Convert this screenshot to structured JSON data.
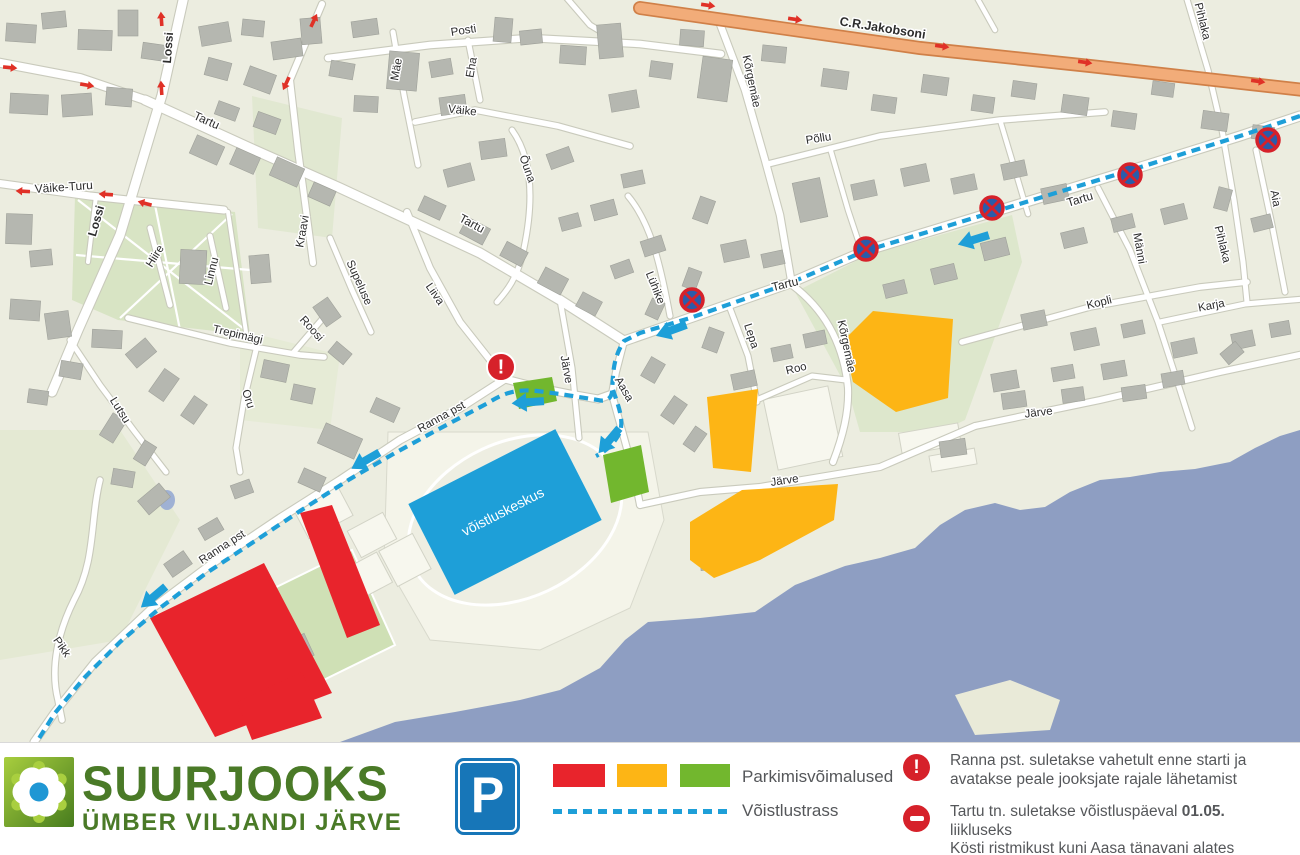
{
  "colors": {
    "land": "#ECEDE0",
    "water": "#8E9EC2",
    "park": "#D8E4C4",
    "field": "#DDE7CC",
    "roadCasing": "#C9CABC",
    "orangeFill": "#F2AC79",
    "orangeCasing": "#D08048",
    "route": "#1E9FD8",
    "red": "#E8242C",
    "yellow": "#FDB515",
    "green": "#72B72E",
    "bld": "#B5B7B0",
    "bldStroke": "#9FA19A",
    "signBlue": "#2A5CAA",
    "signBlueP": "#1776B8",
    "signRed": "#D6212A",
    "arrowRed": "#E03127",
    "textDark": "#55575A",
    "logoGreen": "#4A7A27",
    "logoLightGreen": "#A9CF3F",
    "logoBlue": "#1F97D4"
  },
  "map": {
    "stadium_label": {
      "text": "võistluskeskus",
      "x": 505,
      "y": 516,
      "rot": -27,
      "size": 14
    },
    "street_labels": [
      {
        "text": "Lossi",
        "x": 172,
        "y": 48,
        "rot": -86,
        "size": 12,
        "bold": true
      },
      {
        "text": "Lossi",
        "x": 100,
        "y": 222,
        "rot": -74,
        "size": 12,
        "bold": true
      },
      {
        "text": "Tartu",
        "x": 205,
        "y": 124,
        "rot": 24,
        "size": 12,
        "bold": false
      },
      {
        "text": "Väike-Turu",
        "x": 64,
        "y": 191,
        "rot": -4,
        "size": 12,
        "bold": false
      },
      {
        "text": "Hiire",
        "x": 158,
        "y": 258,
        "rot": -58,
        "size": 11.5,
        "bold": false
      },
      {
        "text": "Linnu",
        "x": 215,
        "y": 272,
        "rot": -76,
        "size": 11.5,
        "bold": false
      },
      {
        "text": "Trepimägi",
        "x": 237,
        "y": 338,
        "rot": 13,
        "size": 11.5,
        "bold": false
      },
      {
        "text": "Roosi",
        "x": 309,
        "y": 331,
        "rot": 48,
        "size": 11.5,
        "bold": false
      },
      {
        "text": "Oru",
        "x": 245,
        "y": 400,
        "rot": 72,
        "size": 11.5,
        "bold": false
      },
      {
        "text": "Lutsu",
        "x": 117,
        "y": 412,
        "rot": 58,
        "size": 11.5,
        "bold": false
      },
      {
        "text": "Kraavi",
        "x": 306,
        "y": 232,
        "rot": -80,
        "size": 11.5,
        "bold": false
      },
      {
        "text": "Supeluse",
        "x": 356,
        "y": 284,
        "rot": 66,
        "size": 11.5,
        "bold": false
      },
      {
        "text": "Liiva",
        "x": 432,
        "y": 296,
        "rot": 55,
        "size": 11.5,
        "bold": false
      },
      {
        "text": "Mäe",
        "x": 400,
        "y": 70,
        "rot": -80,
        "size": 11.5,
        "bold": false
      },
      {
        "text": "Posti",
        "x": 464,
        "y": 34,
        "rot": -9,
        "size": 11.5,
        "bold": false
      },
      {
        "text": "Eha",
        "x": 475,
        "y": 68,
        "rot": -80,
        "size": 11.5,
        "bold": false
      },
      {
        "text": "Väike",
        "x": 462,
        "y": 114,
        "rot": 6,
        "size": 11.5,
        "bold": false
      },
      {
        "text": "Õuna",
        "x": 524,
        "y": 170,
        "rot": 70,
        "size": 11.5,
        "bold": false
      },
      {
        "text": "Tartu",
        "x": 470,
        "y": 227,
        "rot": 28,
        "size": 12,
        "bold": false
      },
      {
        "text": "Lühike",
        "x": 652,
        "y": 289,
        "rot": 68,
        "size": 11.5,
        "bold": false
      },
      {
        "text": "Kõrgemäe",
        "x": 748,
        "y": 82,
        "rot": 78,
        "size": 11.5,
        "bold": false
      },
      {
        "text": "Põllu",
        "x": 819,
        "y": 142,
        "rot": -9,
        "size": 11.5,
        "bold": false
      },
      {
        "text": "C.R.Jakobsoni",
        "x": 882,
        "y": 32,
        "rot": 9,
        "size": 12.5,
        "bold": true
      },
      {
        "text": "Kõrgemäe",
        "x": 843,
        "y": 347,
        "rot": 78,
        "size": 11.5,
        "bold": false
      },
      {
        "text": "Lepa",
        "x": 748,
        "y": 337,
        "rot": 72,
        "size": 11.5,
        "bold": false
      },
      {
        "text": "Roo",
        "x": 797,
        "y": 372,
        "rot": -14,
        "size": 11.5,
        "bold": false
      },
      {
        "text": "Tartu",
        "x": 786,
        "y": 288,
        "rot": -14,
        "size": 12,
        "bold": false
      },
      {
        "text": "Tartu",
        "x": 1081,
        "y": 203,
        "rot": -17,
        "size": 12,
        "bold": false
      },
      {
        "text": "Järve",
        "x": 563,
        "y": 370,
        "rot": 80,
        "size": 11.5,
        "bold": false
      },
      {
        "text": "Aasa",
        "x": 621,
        "y": 391,
        "rot": 60,
        "size": 11.5,
        "bold": false
      },
      {
        "text": "Järve",
        "x": 785,
        "y": 484,
        "rot": -8,
        "size": 11.5,
        "bold": false
      },
      {
        "text": "Järve",
        "x": 1039,
        "y": 416,
        "rot": -7,
        "size": 11.5,
        "bold": false
      },
      {
        "text": "Kopli",
        "x": 1100,
        "y": 306,
        "rot": -14,
        "size": 11.5,
        "bold": false
      },
      {
        "text": "Männi",
        "x": 1136,
        "y": 249,
        "rot": 80,
        "size": 11.5,
        "bold": false
      },
      {
        "text": "Pihlaka",
        "x": 1219,
        "y": 245,
        "rot": 76,
        "size": 11.5,
        "bold": false
      },
      {
        "text": "Karja",
        "x": 1212,
        "y": 309,
        "rot": -11,
        "size": 11.5,
        "bold": false
      },
      {
        "text": "Aia",
        "x": 1272,
        "y": 199,
        "rot": 80,
        "size": 11.5,
        "bold": false
      },
      {
        "text": "Pihlaka",
        "x": 1199,
        "y": 22,
        "rot": 76,
        "size": 11.5,
        "bold": false
      },
      {
        "text": "Pikk",
        "x": 59,
        "y": 649,
        "rot": 55,
        "size": 11.5,
        "bold": false
      },
      {
        "text": "Ranna pst",
        "x": 443,
        "y": 420,
        "rot": -29,
        "size": 11.5,
        "bold": false
      },
      {
        "text": "Ranna pst",
        "x": 224,
        "y": 550,
        "rot": -33,
        "size": 11.5,
        "bold": false
      }
    ],
    "parking_zones": [
      {
        "color": "red",
        "points": "150,618 264,563 332,693 215,737"
      },
      {
        "color": "red",
        "points": "300,513 332,505 380,625 347,638"
      },
      {
        "color": "red",
        "points": "237,702 302,672 322,718 252,740"
      },
      {
        "color": "yellow",
        "points": "843,341 873,311 953,319 948,398 896,412 853,382"
      },
      {
        "color": "yellow",
        "points": "707,397 758,389 751,472 713,468"
      },
      {
        "color": "yellow",
        "points": "690,522 742,490 838,484 834,520 760,560 714,578 690,560"
      },
      {
        "color": "green",
        "points": "513,383 552,377 557,401 519,409"
      },
      {
        "color": "green",
        "points": "603,455 641,445 649,492 611,503"
      }
    ],
    "no_stopping_signs": [
      {
        "x": 692,
        "y": 300
      },
      {
        "x": 866,
        "y": 249
      },
      {
        "x": 992,
        "y": 208
      },
      {
        "x": 1130,
        "y": 175
      },
      {
        "x": 1268,
        "y": 140
      }
    ],
    "warning_marker": {
      "x": 501,
      "y": 367,
      "glyph": "!"
    },
    "route_arrows": [
      {
        "x": 963,
        "y": 243,
        "a": 163
      },
      {
        "x": 661,
        "y": 334,
        "a": 160
      },
      {
        "x": 517,
        "y": 403,
        "a": 176
      },
      {
        "x": 356,
        "y": 466,
        "a": 150
      },
      {
        "x": 145,
        "y": 604,
        "a": 140
      },
      {
        "x": 602,
        "y": 449,
        "a": 130
      }
    ],
    "oneway_arrows": [
      {
        "x": 15,
        "y": 68,
        "a": 5
      },
      {
        "x": 92,
        "y": 86,
        "a": 10
      },
      {
        "x": 161,
        "y": 14,
        "a": -94
      },
      {
        "x": 161,
        "y": 83,
        "a": -94
      },
      {
        "x": 284,
        "y": 88,
        "a": 115
      },
      {
        "x": 316,
        "y": 16,
        "a": -65
      },
      {
        "x": 18,
        "y": 191,
        "a": 183
      },
      {
        "x": 101,
        "y": 194,
        "a": 184
      },
      {
        "x": 140,
        "y": 202,
        "a": 195
      },
      {
        "x": 713,
        "y": 6,
        "a": 8
      },
      {
        "x": 800,
        "y": 20,
        "a": 8
      },
      {
        "x": 947,
        "y": 47,
        "a": 8
      },
      {
        "x": 1090,
        "y": 63,
        "a": 8
      },
      {
        "x": 1263,
        "y": 82,
        "a": 8
      }
    ]
  },
  "legend": {
    "logo": {
      "line1": "SUURJOOKS",
      "line2": "ÜMBER VILJANDI JÄRVE"
    },
    "parking_sign_letter": "P",
    "parking_label": "Parkimisvõimalused",
    "route_label": "Võistlustrass",
    "notice1": {
      "glyph": "!",
      "line1": "Ranna pst. suletakse vahetult enne starti ja",
      "line2": "avatakse peale jooksjate rajale lähetamist"
    },
    "notice2": {
      "line1": [
        {
          "t": "Tartu tn. suletakse võistluspäeval ",
          "b": false
        },
        {
          "t": "01.05.",
          "b": true
        },
        {
          "t": " liikluseks",
          "b": false
        }
      ],
      "line2": [
        {
          "t": "Kösti ristmikust kuni Aasa tänavani alates ",
          "b": false
        },
        {
          "t": "12.00-14.45",
          "b": true
        }
      ]
    }
  }
}
